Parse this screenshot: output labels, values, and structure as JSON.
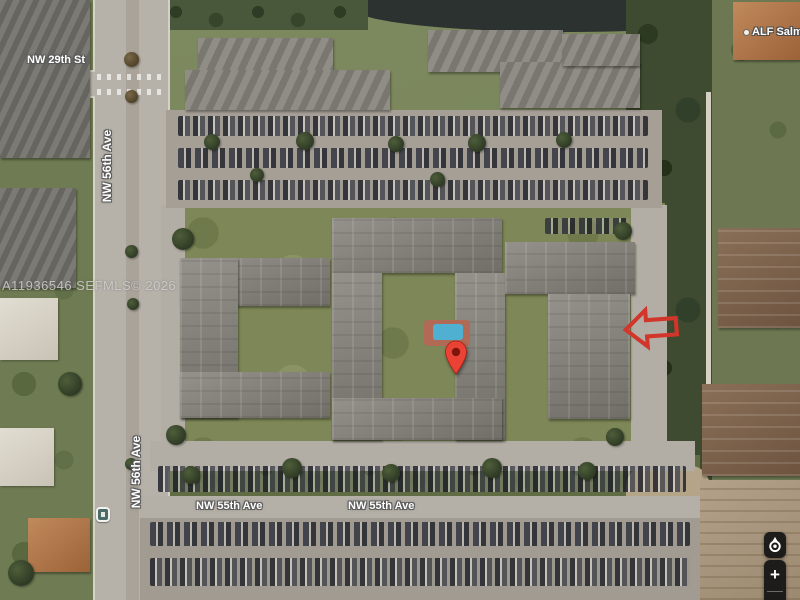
{
  "map": {
    "view_type": "satellite",
    "streets": {
      "nw29th": "NW 29th St",
      "nw56th": "NW 56th Ave",
      "nw55th": "NW 55th Ave"
    },
    "places": {
      "alf": "ALF Salmo"
    },
    "watermark": "A11936546  SEFMLS© 2026",
    "marker": {
      "icon": "red-map-pin",
      "color": "#ea4335",
      "inner_color": "#7e150d"
    },
    "annotation": {
      "icon": "red-outline-arrow-left",
      "color": "#d2362a"
    },
    "transit": {
      "icon": "bus-stop"
    },
    "controls": {
      "locate": {
        "icon": "my-location"
      },
      "zoom_in": {
        "icon": "plus",
        "label": "+"
      }
    },
    "colors": {
      "label_text": "#ffffff",
      "label_halo": "#5a5a5a",
      "watermark": "#d0d0d0",
      "control_bg": "#121212",
      "pool": "#4fb0d2",
      "pond": "#2b3230"
    }
  }
}
